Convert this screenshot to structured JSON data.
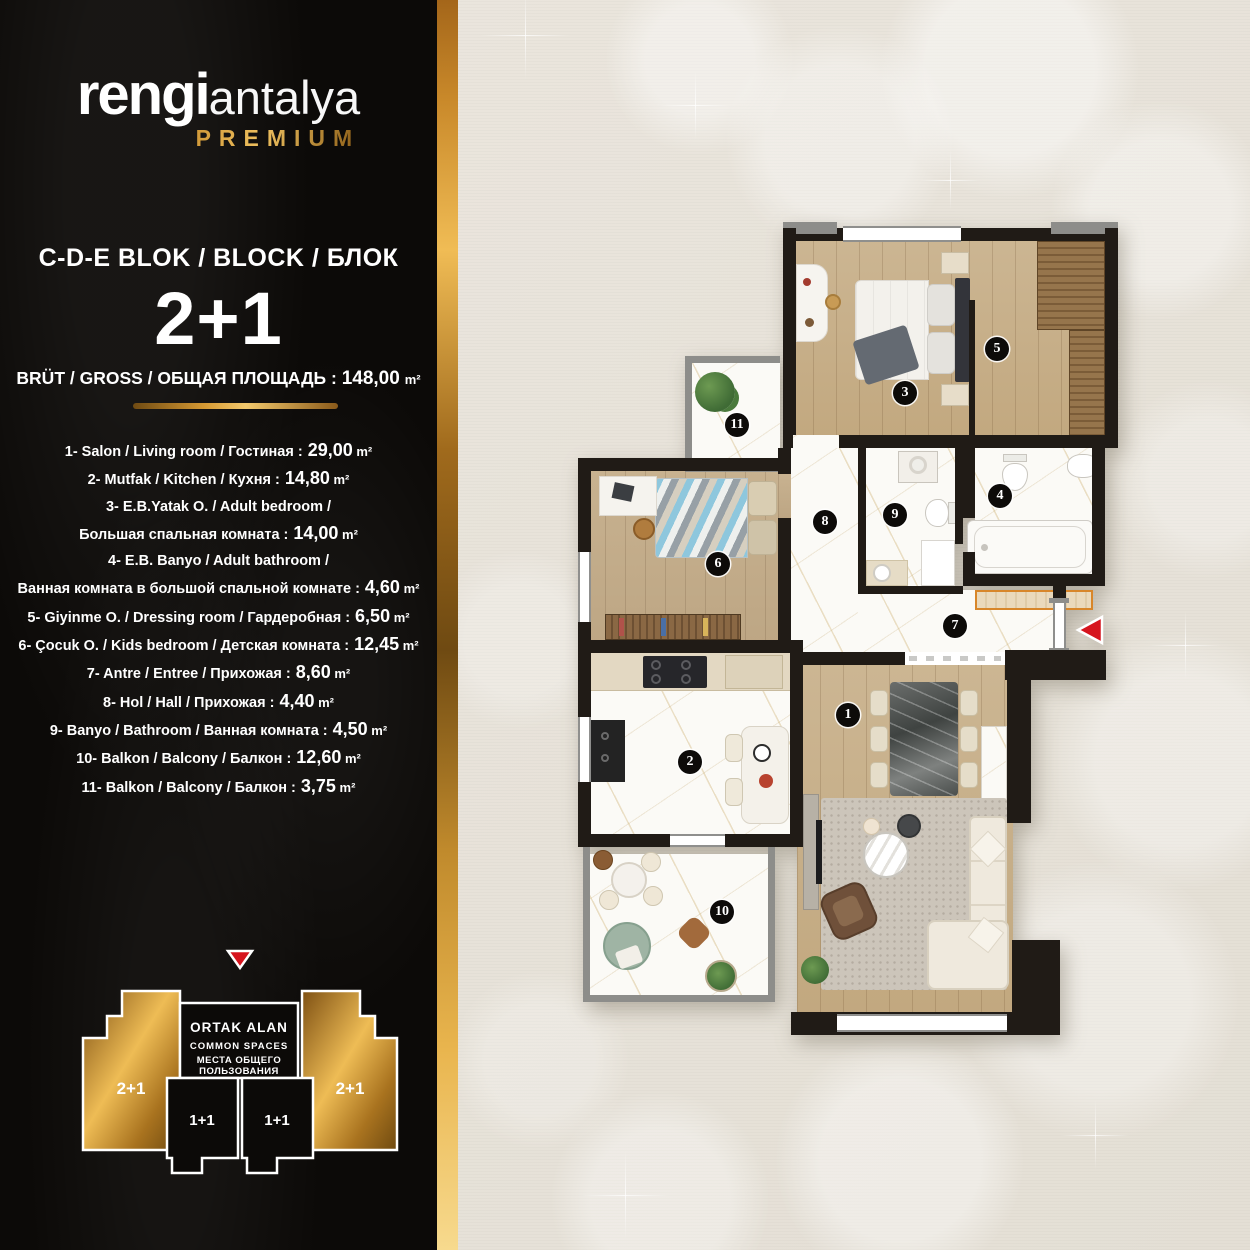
{
  "brand": {
    "wordmark_bold": "rengi",
    "wordmark_light": "antalya",
    "premium_label": "PREMIUM"
  },
  "header": {
    "block_line": "C-D-E BLOK / BLOCK / БЛОК",
    "unit_type": "2+1",
    "gross_prefix": "BRÜT / GROSS / ОБЩАЯ ПЛОЩАДЬ :",
    "gross_area": "148,00",
    "area_unit": "m²"
  },
  "room_list": {
    "area_unit": "m²",
    "items": [
      {
        "label": "1- Salon / Living room / Гостиная :",
        "area": "29,00"
      },
      {
        "label": "2- Mutfak / Kitchen / Кухня :",
        "area": "14,80"
      },
      {
        "label": "3- E.B.Yatak O. / Adult bedroom /",
        "area": null
      },
      {
        "label": "Большая спальная комната :",
        "area": "14,00"
      },
      {
        "label": "4- E.B. Banyo / Adult bathroom /",
        "area": null
      },
      {
        "label": "Ванная комната в большой спальной комнате :",
        "area": "4,60"
      },
      {
        "label": "5- Giyinme O. / Dressing room / Гардеробная :",
        "area": "6,50"
      },
      {
        "label": "6- Çocuk O. / Kids bedroom / Детская комната :",
        "area": "12,45"
      },
      {
        "label": "7- Antre / Entree / Прихожая :",
        "area": "8,60"
      },
      {
        "label": "8- Hol / Hall / Прихожая :",
        "area": "4,40"
      },
      {
        "label": "9- Banyo / Bathroom / Ванная комната :",
        "area": "4,50"
      },
      {
        "label": "10- Balkon / Balcony / Балкон :",
        "area": "12,60"
      },
      {
        "label": "11- Balkon / Balcony / Балкон :",
        "area": "3,75"
      }
    ]
  },
  "floor_plan": {
    "badges": [
      "1",
      "2",
      "3",
      "4",
      "5",
      "6",
      "7",
      "8",
      "9",
      "10",
      "11"
    ]
  },
  "block_diagram": {
    "common_line1": "ORTAK ALAN",
    "common_line2": "COMMON SPACES",
    "common_line3": "МЕСТА ОБЩЕГО",
    "common_line4": "ПОЛЬЗОВАНИЯ",
    "left_unit": "2+1",
    "right_unit": "2+1",
    "inner_left_unit": "1+1",
    "inner_right_unit": "1+1"
  },
  "colors": {
    "gold": "#d79a33",
    "accent_red": "#d6141d",
    "panel_black": "#0c0a08",
    "background_beige": "#e9e4db"
  }
}
